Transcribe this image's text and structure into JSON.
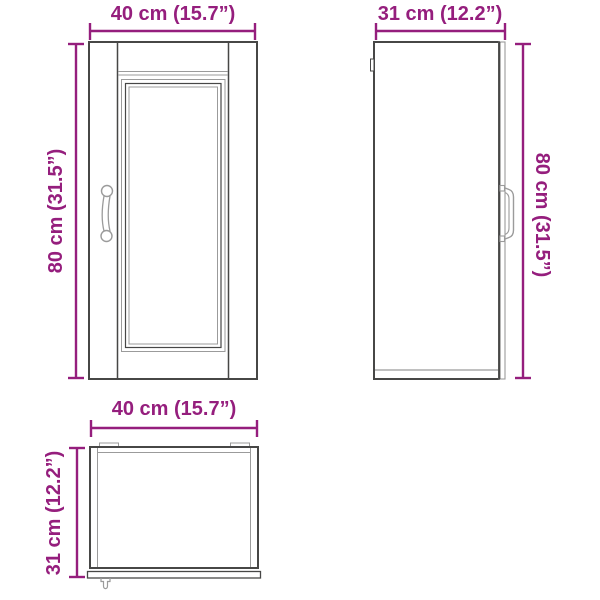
{
  "title": "Cabinet dimension diagram",
  "colors": {
    "dimension_accent": "#951e7d",
    "outline_dark": "#474746",
    "outline_light": "#9b9b9b",
    "background": "#ffffff"
  },
  "views": {
    "front": {
      "name": "front view",
      "width_label": "40 cm (15.7”)",
      "height_label": "80 cm (31.5”)"
    },
    "side": {
      "name": "side view",
      "width_label": "31 cm (12.2”)",
      "height_label": "80 cm (31.5”)"
    },
    "top": {
      "name": "top view",
      "width_label": "40 cm (15.7”)",
      "depth_label": "31 cm (12.2”)"
    }
  }
}
